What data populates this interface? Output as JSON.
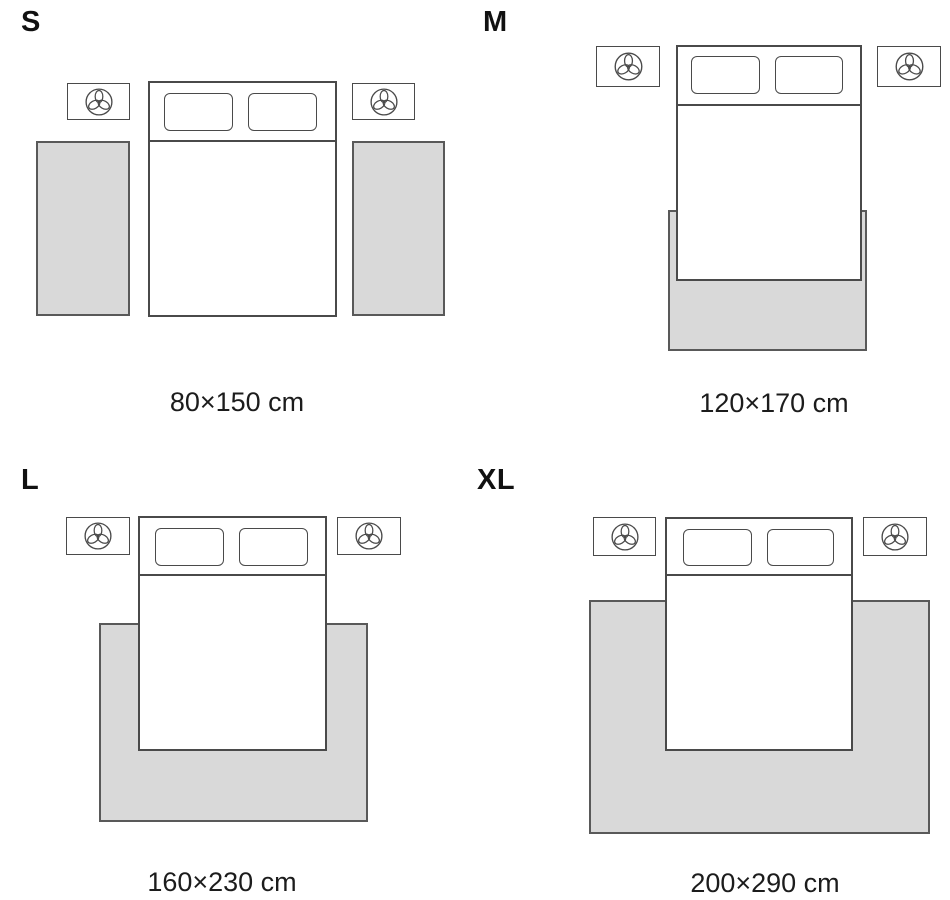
{
  "title": "Rug size guide bedroom layouts",
  "colors": {
    "background": "#ffffff",
    "rug_fill": "#d9d9d9",
    "rug_border": "#595959",
    "line": "#4a4a4a",
    "text": "#1c1c1c"
  },
  "icons": {
    "nightstand_icon": "plant-icon"
  },
  "panels": [
    {
      "id": "s",
      "size_label": "S",
      "caption": "80×150 cm",
      "layout_note": "two runner rugs, one on each side of the bed"
    },
    {
      "id": "m",
      "size_label": "M",
      "caption": "120×170 cm",
      "layout_note": "one rug under the lower part of the bed, slightly wider than bed"
    },
    {
      "id": "l",
      "size_label": "L",
      "caption": "160×230 cm",
      "layout_note": "one wide rug under the lower two-thirds of the bed"
    },
    {
      "id": "xl",
      "size_label": "XL",
      "caption": "200×290 cm",
      "layout_note": "one extra-wide rug under most of the bed"
    }
  ]
}
